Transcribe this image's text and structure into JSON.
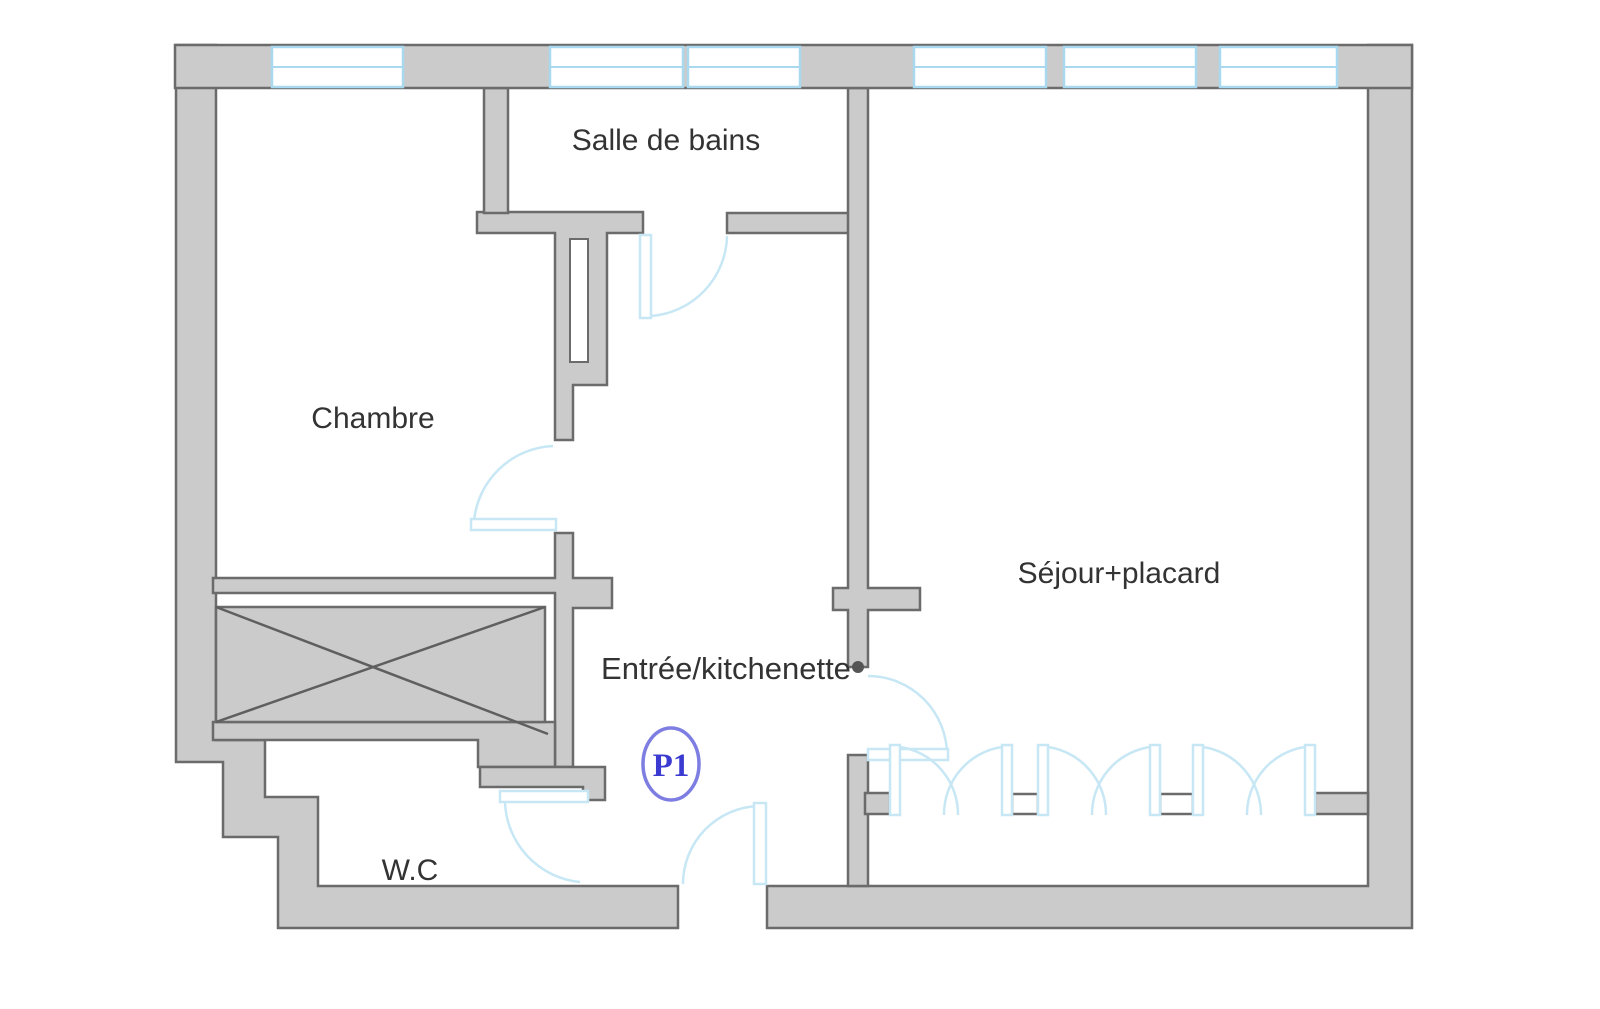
{
  "plan": {
    "rooms": {
      "bathroom": "Salle de bains",
      "bedroom": "Chambre",
      "living": "Séjour+placard",
      "entry": "Entrée/kitchenette",
      "wc": "W.C"
    },
    "door_tag": "P1",
    "colors": {
      "wall_fill": "#cbcbcb",
      "wall_stroke": "#6b6b6b",
      "window_blue": "#a9d9ee",
      "door_arc_blue": "#c7e7f5",
      "label_color": "#333333",
      "door_tag_text": "#3b3bd1",
      "door_tag_ring": "#7d7de2"
    }
  }
}
